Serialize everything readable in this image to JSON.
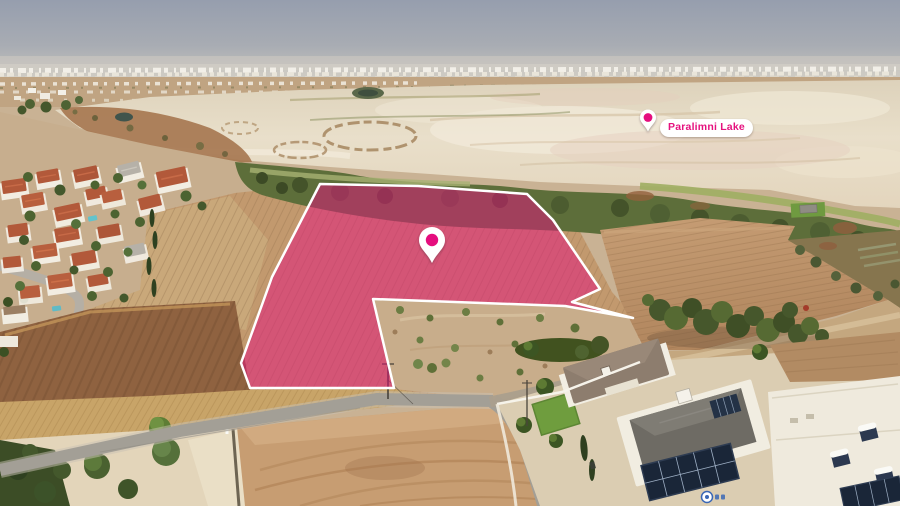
{
  "labels": {
    "lake": "Paralimni Lake"
  },
  "icons": {
    "plot_marker": "location-pin-icon",
    "lake_marker": "location-pin-icon"
  },
  "plot_highlight": {
    "fill": "#E5117E",
    "fill_opacity": "0.5",
    "outline": "#FFFFFF"
  },
  "palette": {
    "brand_magenta": "#E5117E",
    "pin_white": "#FFFFFF",
    "sky": "#9AA2B0",
    "salt_flat": "#E8DDC8",
    "plowed_field": "#C2996E",
    "shore_vegetation": "#5D6E3A",
    "road": "#A39F96",
    "roof_terracotta": "#B2593A",
    "solar_panel": "#1A2638"
  }
}
